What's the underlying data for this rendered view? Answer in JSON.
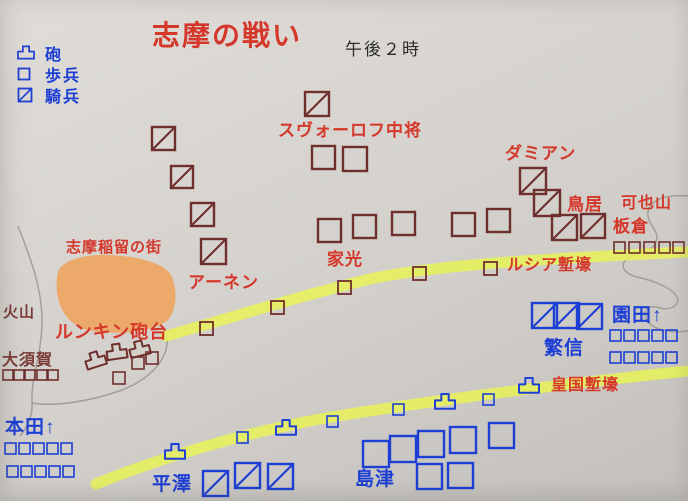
{
  "title": "志摩の戦い",
  "time": "午後２時",
  "legend": {
    "items": [
      {
        "symbol": "artillery",
        "label": "砲"
      },
      {
        "symbol": "infantry",
        "label": "歩兵"
      },
      {
        "symbol": "cavalry",
        "label": "騎兵"
      }
    ]
  },
  "colors": {
    "paper": "#d8d5d1",
    "red_army": "#6f2f2c",
    "red": "#d5372b",
    "maroon": "#7a3a34",
    "blue": "#1d3fd3",
    "highlighter": "#e7f257",
    "town": "#f0a053",
    "terrain": "#9a9793"
  },
  "map": {
    "terrain": [
      {
        "id": "coastline",
        "d": "M18,226 C28,252 43,288 42,324 C41,358 31,378 32,402 C33,416 27,428 20,436"
      },
      {
        "id": "bay",
        "d": "M167,337 C169,358 152,378 122,390 C92,401 55,407 32,403"
      },
      {
        "id": "mountain-outline",
        "d": "M688,196 C662,194 646,202 648,216 C650,228 660,231 656,242 C652,253 636,252 627,259 C619,265 624,274 637,277 C655,281 672,288 677,297 C681,305 670,311 660,308 C648,304 641,311 647,320 C653,331 672,333 688,331"
      }
    ],
    "town": {
      "path": "M58,272 C62,260 85,254 108,255 C135,256 165,262 172,277 C178,293 176,310 168,320 C155,332 115,336 88,330 C65,325 52,300 58,272 Z"
    },
    "trenches": [
      {
        "id": "lucia-trench",
        "path": "M166,336 C230,318 300,296 370,279 C440,264 560,258 688,252"
      },
      {
        "id": "kokoku-trench",
        "path": "M96,484 C160,458 240,434 320,419 C420,402 560,384 688,371"
      }
    ],
    "units": [
      {
        "a": "r",
        "t": "cav",
        "x": 152,
        "y": 127,
        "s": 23
      },
      {
        "a": "r",
        "t": "cav",
        "x": 171,
        "y": 166,
        "s": 22
      },
      {
        "a": "r",
        "t": "cav",
        "x": 191,
        "y": 203,
        "s": 23
      },
      {
        "a": "r",
        "t": "cav",
        "x": 201,
        "y": 239,
        "s": 25
      },
      {
        "a": "r",
        "t": "cav",
        "x": 305,
        "y": 92,
        "s": 24
      },
      {
        "a": "r",
        "t": "cav",
        "x": 520,
        "y": 168,
        "s": 26
      },
      {
        "a": "r",
        "t": "cav",
        "x": 534,
        "y": 190,
        "s": 26
      },
      {
        "a": "r",
        "t": "cav",
        "x": 552,
        "y": 215,
        "s": 25
      },
      {
        "a": "r",
        "t": "cav",
        "x": 581,
        "y": 214,
        "s": 24
      },
      {
        "a": "r",
        "t": "inf",
        "x": 312,
        "y": 146,
        "s": 23
      },
      {
        "a": "r",
        "t": "inf",
        "x": 343,
        "y": 147,
        "s": 24
      },
      {
        "a": "r",
        "t": "inf",
        "x": 318,
        "y": 219,
        "s": 23
      },
      {
        "a": "r",
        "t": "inf",
        "x": 353,
        "y": 215,
        "s": 23
      },
      {
        "a": "r",
        "t": "inf",
        "x": 392,
        "y": 212,
        "s": 23
      },
      {
        "a": "r",
        "t": "inf",
        "x": 452,
        "y": 213,
        "s": 23
      },
      {
        "a": "r",
        "t": "inf",
        "x": 487,
        "y": 209,
        "s": 23
      },
      {
        "a": "r",
        "t": "sq",
        "x": 200,
        "y": 322,
        "s": 13
      },
      {
        "a": "r",
        "t": "sq",
        "x": 271,
        "y": 301,
        "s": 13
      },
      {
        "a": "r",
        "t": "sq",
        "x": 338,
        "y": 281,
        "s": 13
      },
      {
        "a": "r",
        "t": "sq",
        "x": 413,
        "y": 267,
        "s": 13
      },
      {
        "a": "r",
        "t": "sq",
        "x": 484,
        "y": 262,
        "s": 13
      },
      {
        "a": "r",
        "t": "sq",
        "x": 614,
        "y": 242,
        "s": 11
      },
      {
        "a": "r",
        "t": "sq",
        "x": 629,
        "y": 242,
        "s": 11
      },
      {
        "a": "r",
        "t": "sq",
        "x": 644,
        "y": 242,
        "s": 11
      },
      {
        "a": "r",
        "t": "sq",
        "x": 659,
        "y": 242,
        "s": 11
      },
      {
        "a": "r",
        "t": "sq",
        "x": 673,
        "y": 242,
        "s": 11
      },
      {
        "a": "r",
        "t": "sq",
        "x": 3,
        "y": 370,
        "s": 10
      },
      {
        "a": "r",
        "t": "sq",
        "x": 14,
        "y": 370,
        "s": 10
      },
      {
        "a": "r",
        "t": "sq",
        "x": 25,
        "y": 370,
        "s": 10
      },
      {
        "a": "r",
        "t": "sq",
        "x": 37,
        "y": 370,
        "s": 10
      },
      {
        "a": "r",
        "t": "sq",
        "x": 48,
        "y": 370,
        "s": 10
      },
      {
        "a": "r",
        "t": "sq",
        "x": 132,
        "y": 357,
        "s": 12
      },
      {
        "a": "r",
        "t": "sq",
        "x": 146,
        "y": 352,
        "s": 12
      },
      {
        "a": "r",
        "t": "sq",
        "x": 113,
        "y": 372,
        "s": 12
      },
      {
        "a": "r",
        "t": "art",
        "x": 86,
        "y": 352,
        "s": 20,
        "r": -18
      },
      {
        "a": "r",
        "t": "art",
        "x": 107,
        "y": 344,
        "s": 20,
        "r": -8
      },
      {
        "a": "r",
        "t": "art",
        "x": 130,
        "y": 341,
        "s": 20,
        "r": -14
      },
      {
        "a": "b",
        "t": "cav",
        "x": 532,
        "y": 303,
        "s": 25
      },
      {
        "a": "b",
        "t": "cav",
        "x": 554,
        "y": 303,
        "s": 25
      },
      {
        "a": "b",
        "t": "cav",
        "x": 577,
        "y": 304,
        "s": 25
      },
      {
        "a": "b",
        "t": "cav",
        "x": 203,
        "y": 471,
        "s": 25
      },
      {
        "a": "b",
        "t": "cav",
        "x": 235,
        "y": 463,
        "s": 25
      },
      {
        "a": "b",
        "t": "cav",
        "x": 268,
        "y": 464,
        "s": 25
      },
      {
        "a": "b",
        "t": "inf",
        "x": 363,
        "y": 441,
        "s": 26
      },
      {
        "a": "b",
        "t": "inf",
        "x": 390,
        "y": 436,
        "s": 26
      },
      {
        "a": "b",
        "t": "inf",
        "x": 418,
        "y": 431,
        "s": 26
      },
      {
        "a": "b",
        "t": "inf",
        "x": 450,
        "y": 427,
        "s": 26
      },
      {
        "a": "b",
        "t": "inf",
        "x": 489,
        "y": 423,
        "s": 25
      },
      {
        "a": "b",
        "t": "inf",
        "x": 417,
        "y": 464,
        "s": 25
      },
      {
        "a": "b",
        "t": "inf",
        "x": 448,
        "y": 463,
        "s": 25
      },
      {
        "a": "b",
        "t": "sq",
        "x": 5,
        "y": 443,
        "s": 11
      },
      {
        "a": "b",
        "t": "sq",
        "x": 19,
        "y": 443,
        "s": 11
      },
      {
        "a": "b",
        "t": "sq",
        "x": 33,
        "y": 443,
        "s": 11
      },
      {
        "a": "b",
        "t": "sq",
        "x": 47,
        "y": 443,
        "s": 11
      },
      {
        "a": "b",
        "t": "sq",
        "x": 61,
        "y": 443,
        "s": 11
      },
      {
        "a": "b",
        "t": "sq",
        "x": 7,
        "y": 466,
        "s": 11
      },
      {
        "a": "b",
        "t": "sq",
        "x": 21,
        "y": 466,
        "s": 11
      },
      {
        "a": "b",
        "t": "sq",
        "x": 35,
        "y": 466,
        "s": 11
      },
      {
        "a": "b",
        "t": "sq",
        "x": 49,
        "y": 466,
        "s": 11
      },
      {
        "a": "b",
        "t": "sq",
        "x": 63,
        "y": 466,
        "s": 11
      },
      {
        "a": "b",
        "t": "sq",
        "x": 610,
        "y": 330,
        "s": 11
      },
      {
        "a": "b",
        "t": "sq",
        "x": 624,
        "y": 330,
        "s": 11
      },
      {
        "a": "b",
        "t": "sq",
        "x": 638,
        "y": 330,
        "s": 11
      },
      {
        "a": "b",
        "t": "sq",
        "x": 652,
        "y": 330,
        "s": 11
      },
      {
        "a": "b",
        "t": "sq",
        "x": 666,
        "y": 330,
        "s": 11
      },
      {
        "a": "b",
        "t": "sq",
        "x": 610,
        "y": 352,
        "s": 11
      },
      {
        "a": "b",
        "t": "sq",
        "x": 624,
        "y": 352,
        "s": 11
      },
      {
        "a": "b",
        "t": "sq",
        "x": 638,
        "y": 352,
        "s": 11
      },
      {
        "a": "b",
        "t": "sq",
        "x": 652,
        "y": 352,
        "s": 11
      },
      {
        "a": "b",
        "t": "sq",
        "x": 666,
        "y": 352,
        "s": 11
      },
      {
        "a": "b",
        "t": "sq",
        "x": 237,
        "y": 432,
        "s": 11
      },
      {
        "a": "b",
        "t": "sq",
        "x": 327,
        "y": 416,
        "s": 11
      },
      {
        "a": "b",
        "t": "sq",
        "x": 393,
        "y": 404,
        "s": 11
      },
      {
        "a": "b",
        "t": "sq",
        "x": 483,
        "y": 394,
        "s": 11
      },
      {
        "a": "b",
        "t": "art",
        "x": 165,
        "y": 444,
        "s": 20
      },
      {
        "a": "b",
        "t": "art",
        "x": 276,
        "y": 420,
        "s": 20
      },
      {
        "a": "b",
        "t": "art",
        "x": 435,
        "y": 394,
        "s": 20
      },
      {
        "a": "b",
        "t": "art",
        "x": 519,
        "y": 378,
        "s": 20
      }
    ],
    "labels": [
      {
        "id": "suvorov",
        "text": "スヴォーロフ中将",
        "x": 278,
        "y": 136,
        "s": 17,
        "c": "red"
      },
      {
        "id": "damian",
        "text": "ダミアン",
        "x": 505,
        "y": 159,
        "s": 17,
        "c": "red"
      },
      {
        "id": "torii",
        "text": "鳥居",
        "x": 567,
        "y": 210,
        "s": 17,
        "c": "red"
      },
      {
        "id": "kayasan",
        "text": "可也山",
        "x": 621,
        "y": 208,
        "s": 16,
        "c": "red"
      },
      {
        "id": "itakura",
        "text": "板倉",
        "x": 613,
        "y": 232,
        "s": 17,
        "c": "red"
      },
      {
        "id": "iemitsu",
        "text": "家光",
        "x": 327,
        "y": 265,
        "s": 17,
        "c": "red"
      },
      {
        "id": "arnen",
        "text": "アーネン",
        "x": 188,
        "y": 288,
        "s": 17,
        "c": "red"
      },
      {
        "id": "town",
        "text": "志摩稲留の街",
        "x": 66,
        "y": 252,
        "s": 15,
        "c": "red"
      },
      {
        "id": "runkin",
        "text": "ルンキン砲台",
        "x": 55,
        "y": 338,
        "s": 18,
        "c": "red"
      },
      {
        "id": "lucia-trench",
        "text": "ルシア塹壕",
        "x": 507,
        "y": 270,
        "s": 16,
        "c": "red"
      },
      {
        "id": "kokoku-trench",
        "text": "皇国塹壕",
        "x": 551,
        "y": 390,
        "s": 16,
        "c": "red"
      },
      {
        "id": "kazan",
        "text": "火山",
        "x": 3,
        "y": 317,
        "s": 15,
        "c": "maroon"
      },
      {
        "id": "osuga",
        "text": "大須賀",
        "x": 2,
        "y": 365,
        "s": 16,
        "c": "maroon"
      },
      {
        "id": "honda",
        "text": "本田↑",
        "x": 5,
        "y": 433,
        "s": 19,
        "c": "blue"
      },
      {
        "id": "hirasawa",
        "text": "平澤",
        "x": 152,
        "y": 490,
        "s": 19,
        "c": "blue"
      },
      {
        "id": "shimazu",
        "text": "島津",
        "x": 355,
        "y": 485,
        "s": 19,
        "c": "blue"
      },
      {
        "id": "shigenobu",
        "text": "繁信",
        "x": 544,
        "y": 354,
        "s": 19,
        "c": "blue"
      },
      {
        "id": "sonoda",
        "text": "園田↑",
        "x": 612,
        "y": 321,
        "s": 19,
        "c": "blue"
      }
    ]
  }
}
